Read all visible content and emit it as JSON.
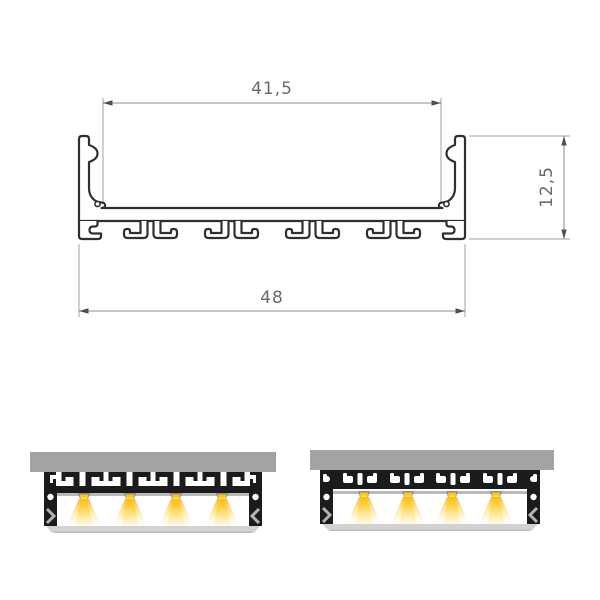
{
  "drawing": {
    "title": "LED aluminium profile cross-section",
    "dimension_labels": {
      "inner_width": "41,5",
      "overall_width": "48",
      "height": "12,5"
    },
    "colors": {
      "outline": "#2f2f2f",
      "dimension_line": "#8a8a8a",
      "extension_line": "#a0a0a0",
      "dimension_text": "#6a6a6a"
    }
  },
  "renders": {
    "count": 2,
    "leds_per_profile": 4,
    "colors": {
      "mounting_plate": "#a3a3a3",
      "profile_body": "#1b1b1b",
      "led_strip": "#b9b9b9",
      "led_nub": "#8f8f8f",
      "glow_core": "#ffc21a",
      "glow_mid": "#fbd96e",
      "glow_pale": "#fdf4d4",
      "diffuser": "#d2d2d2",
      "wall_highlight": "#b3b3b3"
    }
  }
}
